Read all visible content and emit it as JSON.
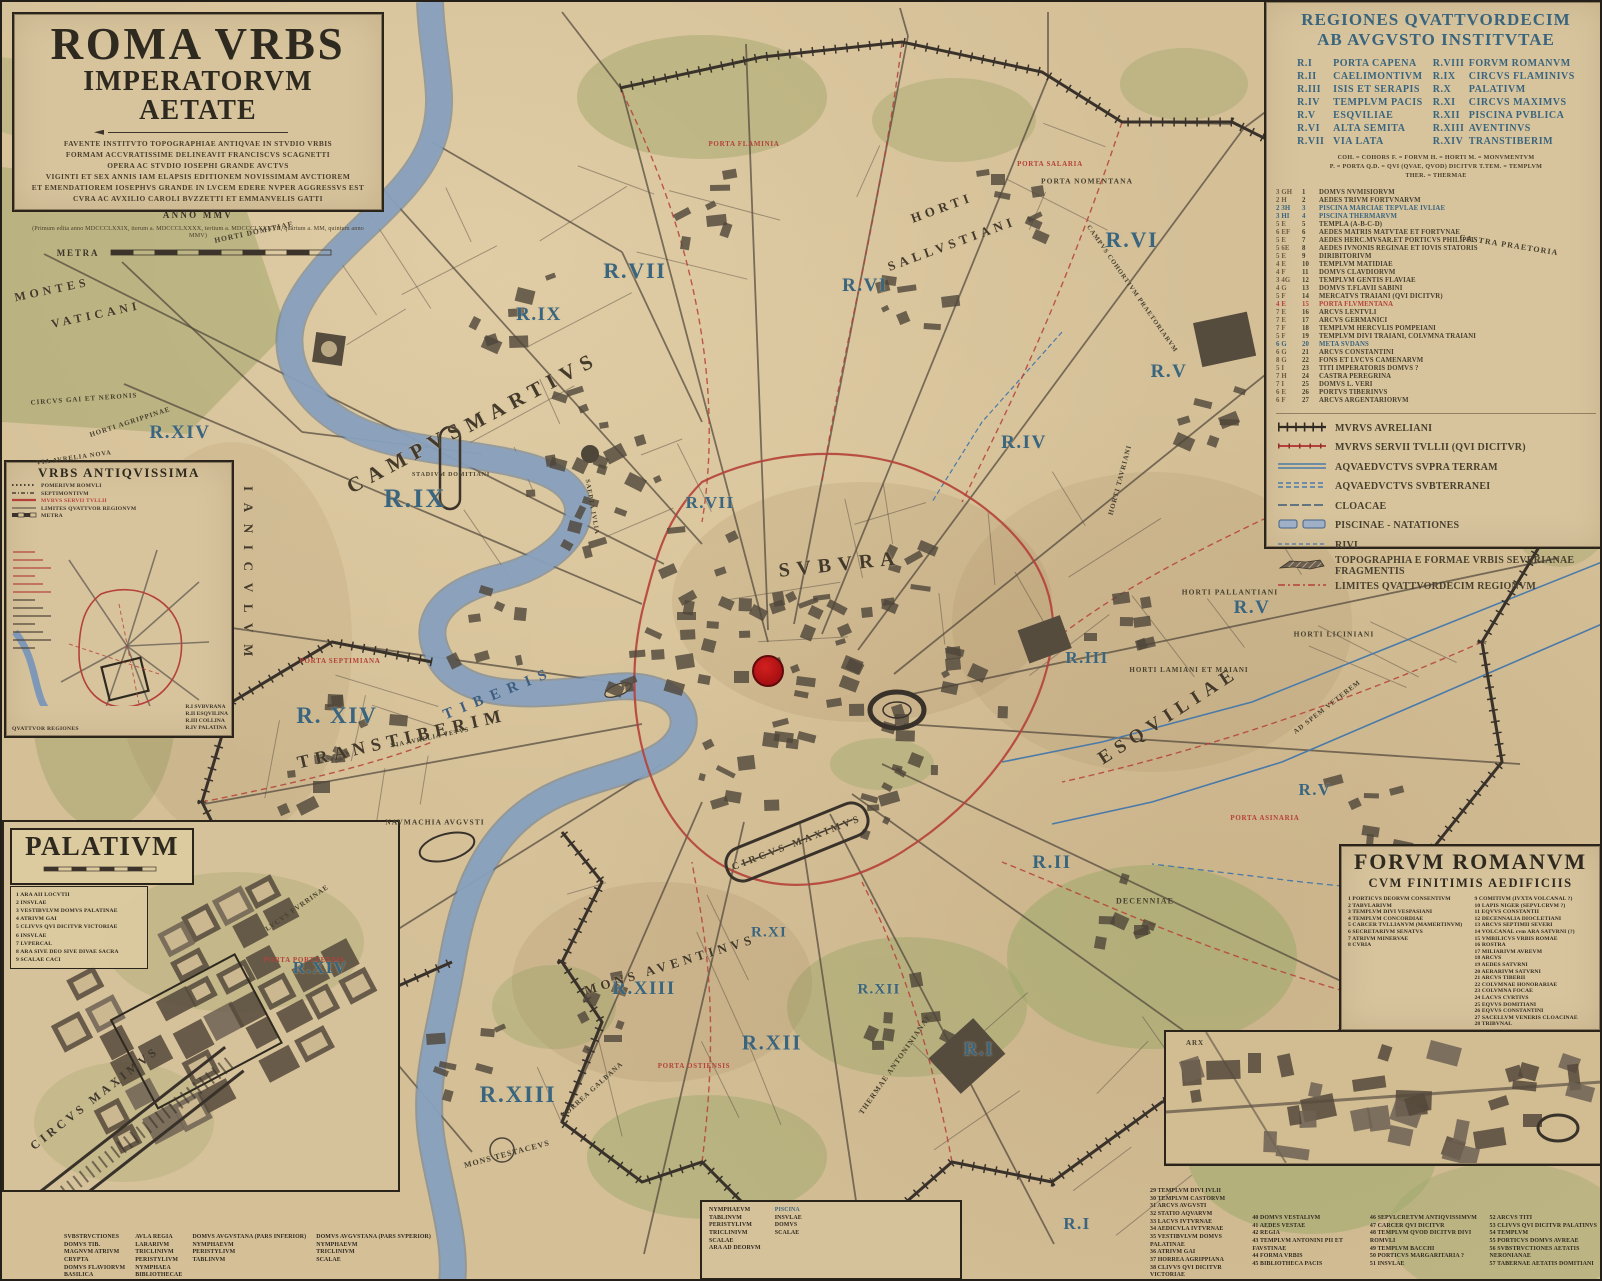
{
  "colors": {
    "parchment": "#d4bf97",
    "ink": "#3c342a",
    "region_blue": "#3a657f",
    "accent_red": "#b5413a",
    "river": "#8ba3c0",
    "dot": "#bf1419"
  },
  "title_block": {
    "title": "ROMA VRBS",
    "subtitle": "IMPERATORVM AETATE",
    "dedication": [
      "FAVENTE INSTITVTO TOPOGRAPHIAE ANTIQVAE IN STVDIO VRBIS",
      "FORMAM ACCVRATISSIME DELINEAVIT FRANCISCVS SCAGNETTI",
      "OPERA AC STVDIO IOSEPHI GRANDE AVCTVS",
      "VIGINTI ET SEX ANNIS IAM ELAPSIS EDITIONEM NOVISSIMAM AVCTIOREM",
      "ET EMENDATIOREM IOSEPHVS GRANDE IN LVCEM EDERE NVPER AGGRESSVS EST",
      "CVRA AC AVXILIO CAROLI BVZZETTI ET EMMANVELIS GATTI"
    ],
    "anno": "ANNO MMV",
    "editions": "(Primum edita anno MDCCCLXXIX, iterum a. MDCCCLXXXX, tertium a. MDCCCLXXXVII, quartum a. MM, quintum anno MMV)",
    "scale_label": "METRA"
  },
  "regiones_legend": {
    "title_line1": "REGIONES QVATTVORDECIM",
    "title_line2": "AB AVGVSTO INSTITVTAE",
    "regions": [
      {
        "num": "R.I",
        "name": "PORTA CAPENA"
      },
      {
        "num": "R.II",
        "name": "CAELIMONTIVM"
      },
      {
        "num": "R.III",
        "name": "ISIS ET SERAPIS"
      },
      {
        "num": "R.IV",
        "name": "TEMPLVM PACIS"
      },
      {
        "num": "R.V",
        "name": "ESQVILIAE"
      },
      {
        "num": "R.VI",
        "name": "ALTA SEMITA"
      },
      {
        "num": "R.VII",
        "name": "VIA LATA"
      },
      {
        "num": "R.VIII",
        "name": "FORVM ROMANVM"
      },
      {
        "num": "R.IX",
        "name": "CIRCVS FLAMINIVS"
      },
      {
        "num": "R.X",
        "name": "PALATIVM"
      },
      {
        "num": "R.XI",
        "name": "CIRCVS MAXIMVS"
      },
      {
        "num": "R.XII",
        "name": "PISCINA PVBLICA"
      },
      {
        "num": "R.XIII",
        "name": "AVENTINVS"
      },
      {
        "num": "R.XIV",
        "name": "TRANSTIBERIM"
      }
    ],
    "abbreviations": [
      "COH. = COHORS      F. = FORVM      H. = HORTI      M. = MONVMENTVM",
      "P. = PORTA      Q.D. = QVI (QVAE, QVOD) DICITVR      T.TEM. = TEMPLVM",
      "THER. = THERMAE"
    ],
    "monuments": [
      {
        "g": "3 GH",
        "n": "1",
        "t": "DOMVS NVMISIORVM"
      },
      {
        "g": "2 H",
        "n": "2",
        "t": "AEDES TRIVM FORTVNARVM"
      },
      {
        "g": "2 3H",
        "n": "3",
        "t": "PISCINA MARCIAE TEPVLAE IVLIAE",
        "c": "b"
      },
      {
        "g": "3 HI",
        "n": "4",
        "t": "PISCINA THERMARVM",
        "c": "b"
      },
      {
        "g": "5 E",
        "n": "5",
        "t": "TEMPLA  (A-B-C-D)"
      },
      {
        "g": "6 EF",
        "n": "6",
        "t": "AEDES MATRIS MATVTAE ET FORTVNAE"
      },
      {
        "g": "5 E",
        "n": "7",
        "t": "AEDES HERC.MVSAR.ET PORTICVS PHILIPPI"
      },
      {
        "g": "5 6E",
        "n": "8",
        "t": "AEDES IVNONIS REGINAE ET IOVIS STATORIS"
      },
      {
        "g": "5 E",
        "n": "9",
        "t": "DIRIBITORIVM"
      },
      {
        "g": "4 E",
        "n": "10",
        "t": "TEMPLVM MATIDIAE"
      },
      {
        "g": "4 F",
        "n": "11",
        "t": "DOMVS CLAVDIORVM"
      },
      {
        "g": "3 4G",
        "n": "12",
        "t": "TEMPLVM GENTIS FLAVIAE"
      },
      {
        "g": "4 G",
        "n": "13",
        "t": "DOMVS T.FLAVII SABINI"
      },
      {
        "g": "5 F",
        "n": "14",
        "t": "MERCATVS TRAIANI (QVI DICITVR)"
      },
      {
        "g": "4 E",
        "n": "15",
        "t": "PORTA FLVMENTANA",
        "c": "r"
      },
      {
        "g": "7 E",
        "n": "16",
        "t": "ARCVS LENTVLI"
      },
      {
        "g": "7 E",
        "n": "17",
        "t": "ARCVS GERMANICI"
      },
      {
        "g": "7 F",
        "n": "18",
        "t": "TEMPLVM HERCVLIS POMPEIANI"
      },
      {
        "g": "5 F",
        "n": "19",
        "t": "TEMPLVM DIVI TRAIANI, COLVMNA TRAIANI"
      },
      {
        "g": "6 G",
        "n": "20",
        "t": "META SVDANS",
        "c": "b"
      },
      {
        "g": "6 G",
        "n": "21",
        "t": "ARCVS CONSTANTINI"
      },
      {
        "g": "8 G",
        "n": "22",
        "t": "FONS ET LVCVS CAMENARVM"
      },
      {
        "g": "5 I",
        "n": "23",
        "t": "TITI IMPERATORIS DOMVS ?"
      },
      {
        "g": "7 H",
        "n": "24",
        "t": "CASTRA PEREGRINA"
      },
      {
        "g": "7 I",
        "n": "25",
        "t": "DOMVS L. VERI"
      },
      {
        "g": "6 E",
        "n": "26",
        "t": "PORTVS TIBERINVS"
      },
      {
        "g": "6 F",
        "n": "27",
        "t": "ARCVS ARGENTARIORVM"
      }
    ],
    "symbols": [
      {
        "type": "wall-black",
        "label": "MVRVS AVRELIANI"
      },
      {
        "type": "wall-red",
        "label": "MVRVS SERVII TVLLII (QVI DICITVR)"
      },
      {
        "type": "aq-solid",
        "label": "AQVAEDVCTVS SVPRA TERRAM"
      },
      {
        "type": "aq-dash",
        "label": "AQVAEDVCTVS SVBTERRANEI"
      },
      {
        "type": "cloacae",
        "label": "CLOACAE"
      },
      {
        "type": "piscinae",
        "label": "PISCINAE - NATATIONES"
      },
      {
        "type": "rivi",
        "label": "RIVI"
      },
      {
        "type": "frag",
        "label": "TOPOGRAPHIA E FORMAE VRBIS SEVERIANAE FRAGMENTIS"
      },
      {
        "type": "limites",
        "label": "LIMITES QVATTVORDECIM REGIONVM"
      }
    ]
  },
  "urbs_antiquissima": {
    "title": "VRBS ANTIQVISSIMA",
    "legend": [
      {
        "type": "pomerium",
        "label": "POMERIVM ROMVLI"
      },
      {
        "type": "septimontium",
        "label": "SEPTIMONTIVM"
      },
      {
        "type": "murus",
        "label": "MVRVS SERVII TVLLII",
        "red": true
      },
      {
        "type": "limites",
        "label": "LIMITES QVATTVOR REGIONVM"
      }
    ],
    "scale_label": "METRA",
    "regions_title": "QVATTVOR REGIONES",
    "regions": [
      "R.I  SVBVRANA",
      "R.II  ESQVILINA",
      "R.III  COLLINA",
      "R.IV  PALATINA"
    ]
  },
  "palatium": {
    "title": "PALATIVM",
    "items": [
      "1  ARA AII LOCVTII",
      "2  INSVLAE",
      "3  VESTIBVLVM DOMVS PALATINAE",
      "4  ATRIVM GAI",
      "5  CLIVVS QVI DICITVR VICTORIAE",
      "6  INSVLAE",
      "7  LVPERCAL",
      "8  ARA SIVE DEO SIVE DIVAE SACRA",
      "9  SCALAE CACI"
    ],
    "circus_label": "CIRCVS MAXIMVS",
    "strip1_cols": [
      [
        "SVBSTRVCTIONES",
        "DOMVS TIB.",
        "MAGNVM ATRIVM",
        "CRYPTA",
        "DOMVS FLAVIORVM",
        "BASILICA"
      ],
      [
        "AVLA REGIA",
        "LARARIVM",
        "TRICLINIVM",
        "PERISTYLIVM",
        "NYMPHAEA",
        "BIBLIOTHECAE"
      ],
      [
        "DOMVS AVGVSTANA (PARS INFERIOR)",
        "NYMPHAEVM",
        "PERISTYLIVM",
        "TABLINVM"
      ],
      [
        "DOMVS AVGVSTANA (PARS SVPERIOR)",
        "NYMPHAEVM",
        "TRICLINIVM",
        "SCALAE"
      ]
    ],
    "strip2_cols": [
      [
        "NYMPHAEVM",
        "TABLINVM",
        "PERISTYLIVM",
        "TRICLINIVM",
        "SCALAE",
        "ARA AD DEORVM"
      ],
      [
        "PISCINA",
        "INSVLAE",
        "DOMVS",
        "SCALAE"
      ]
    ]
  },
  "forum_romanum": {
    "title": "FORVM ROMANVM",
    "subtitle": "CVM FINITIMIS AEDIFICIIS",
    "col1": [
      {
        "n": "1",
        "t": "PORTICVS DEORVM CONSENTIVM"
      },
      {
        "n": "2",
        "t": "TABVLARIVM"
      },
      {
        "n": "3",
        "t": "TEMPLVM DIVI VESPASIANI"
      },
      {
        "n": "4",
        "t": "TEMPLVM CONCORDIAE"
      },
      {
        "n": "5",
        "t": "CARCER TVLLIANVM (MAMERTINVM)"
      },
      {
        "n": "6",
        "t": "SECRETARIVM SENATVS"
      },
      {
        "n": "7",
        "t": "ATRIVM MINERVAE"
      },
      {
        "n": "8",
        "t": "CVRIA"
      }
    ],
    "col2": [
      {
        "n": "9",
        "t": "COMITIVM (IVXTA VOLCANAL ?)"
      },
      {
        "n": "10",
        "t": "LAPIS NIGER (SEPVLCRVM ?)"
      },
      {
        "n": "11",
        "t": "EQVVS CONSTANTII"
      },
      {
        "n": "12",
        "t": "DECENNALIA DIOCLETIANI"
      },
      {
        "n": "13",
        "t": "ARCVS SEPTIMII SEVERI"
      },
      {
        "n": "14",
        "t": "VOLCANAL cvm ARA SATVRNI (?)"
      },
      {
        "n": "15",
        "t": "VMBILICVS VRBIS ROMAE"
      },
      {
        "n": "16",
        "t": "ROSTRA"
      },
      {
        "n": "17",
        "t": "MILIARIVM AVREVM"
      },
      {
        "n": "18",
        "t": "ARCVS"
      },
      {
        "n": "19",
        "t": "AEDES SATVRNI"
      },
      {
        "n": "20",
        "t": "AERARIVM SATVRNI"
      },
      {
        "n": "21",
        "t": "ARCVS TIBERII"
      },
      {
        "n": "22",
        "t": "COLVMNAE HONORARIAE"
      },
      {
        "n": "23",
        "t": "COLVMNA FOCAE"
      },
      {
        "n": "24",
        "t": "LACVS CVRTIVS"
      },
      {
        "n": "25",
        "t": "EQVVS DOMITIANI"
      },
      {
        "n": "26",
        "t": "EQVVS CONSTANTINI"
      },
      {
        "n": "27",
        "t": "SACELLVM VENERIS CLOACINAE"
      },
      {
        "n": "28",
        "t": "TRIBVNAL"
      }
    ],
    "strip_cols": [
      [
        {
          "n": "29",
          "t": "TEMPLVM DIVI IVLII"
        },
        {
          "n": "30",
          "t": "TEMPLVM CASTORVM"
        },
        {
          "n": "31",
          "t": "ARCVS AVGVSTI"
        },
        {
          "n": "32",
          "t": "STATIO AQVARVM"
        },
        {
          "n": "33",
          "t": "LACVS IVTVRNAE"
        },
        {
          "n": "34",
          "t": "AEDICVLA IVTVRNAE"
        },
        {
          "n": "35",
          "t": "VESTIBVLVM DOMVS PALATINAE"
        },
        {
          "n": "36",
          "t": "ATRIVM GAI"
        },
        {
          "n": "37",
          "t": "HORREA AGRIPPIANA"
        },
        {
          "n": "38",
          "t": "CLIVVS QVI DICITVR VICTORIAE"
        },
        {
          "n": "39",
          "t": "ARA AII LOCVTII"
        }
      ],
      [
        {
          "n": "40",
          "t": "DOMVS VESTALIVM"
        },
        {
          "n": "41",
          "t": "AEDES VESTAE"
        },
        {
          "n": "42",
          "t": "REGIA"
        },
        {
          "n": "43",
          "t": "TEMPLVM ANTONINI PII ET FAVSTINAE"
        },
        {
          "n": "44",
          "t": "FORMA VRBIS"
        },
        {
          "n": "45",
          "t": "BIBLIOTHECA PACIS"
        }
      ],
      [
        {
          "n": "46",
          "t": "SEPVLCRETVM ANTIQVISSIMVM"
        },
        {
          "n": "47",
          "t": "CARCER QVI DICITVR"
        },
        {
          "n": "48",
          "t": "TEMPLVM QVOD DICITVR DIVI ROMVLI"
        },
        {
          "n": "49",
          "t": "TEMPLVM BACCHI"
        },
        {
          "n": "50",
          "t": "PORTICVS MARGARITARIA ?"
        },
        {
          "n": "51",
          "t": "INSVLAE"
        }
      ],
      [
        {
          "n": "52",
          "t": "ARCVS TITI"
        },
        {
          "n": "53",
          "t": "CLIVVS QVI DICITVR PALATINVS"
        },
        {
          "n": "54",
          "t": "TEMPLVM"
        },
        {
          "n": "55",
          "t": "PORTICVS DOMVS AVREAE"
        },
        {
          "n": "56",
          "t": "SVBSTRVCTIONES AETATIS NERONIANAE"
        },
        {
          "n": "57",
          "t": "TABERNAE AETATIS DOMITIANI"
        }
      ]
    ]
  },
  "map_labels": [
    {
      "t": "R.IX",
      "x": 413,
      "y": 497,
      "s": 26,
      "r": 0,
      "c": "rg"
    },
    {
      "t": "R.IX",
      "x": 537,
      "y": 313,
      "s": 19,
      "r": 0,
      "c": "rg"
    },
    {
      "t": "R.VII",
      "x": 633,
      "y": 269,
      "s": 22,
      "r": 0,
      "c": "rg"
    },
    {
      "t": "R.VII",
      "x": 708,
      "y": 501,
      "s": 17,
      "r": 0,
      "c": "rg"
    },
    {
      "t": "R.VI",
      "x": 863,
      "y": 284,
      "s": 19,
      "r": 0,
      "c": "rg"
    },
    {
      "t": "R.VI",
      "x": 1130,
      "y": 238,
      "s": 22,
      "r": 0,
      "c": "rg"
    },
    {
      "t": "R.V",
      "x": 1167,
      "y": 370,
      "s": 19,
      "r": 0,
      "c": "rg"
    },
    {
      "t": "R.V",
      "x": 1250,
      "y": 606,
      "s": 19,
      "r": 0,
      "c": "rg"
    },
    {
      "t": "R.V",
      "x": 1313,
      "y": 788,
      "s": 17,
      "r": 0,
      "c": "rg"
    },
    {
      "t": "R.IV",
      "x": 1022,
      "y": 441,
      "s": 19,
      "r": 0,
      "c": "rg"
    },
    {
      "t": "R.III",
      "x": 1085,
      "y": 656,
      "s": 17,
      "r": 0,
      "c": "rg"
    },
    {
      "t": "R.II",
      "x": 1050,
      "y": 861,
      "s": 19,
      "r": 0,
      "c": "rg"
    },
    {
      "t": "R.I",
      "x": 977,
      "y": 1048,
      "s": 19,
      "r": 0,
      "c": "rg"
    },
    {
      "t": "R.I",
      "x": 1075,
      "y": 1222,
      "s": 17,
      "r": 0,
      "c": "rg"
    },
    {
      "t": "R.XIV",
      "x": 178,
      "y": 431,
      "s": 19,
      "r": 0,
      "c": "rg"
    },
    {
      "t": "R. XIV",
      "x": 335,
      "y": 714,
      "s": 23,
      "r": 0,
      "c": "rg"
    },
    {
      "t": "R.XIV",
      "x": 318,
      "y": 966,
      "s": 17,
      "r": 0,
      "c": "rg"
    },
    {
      "t": "R.XIII",
      "x": 642,
      "y": 987,
      "s": 19,
      "r": 0,
      "c": "rg"
    },
    {
      "t": "R.XIII",
      "x": 516,
      "y": 1093,
      "s": 23,
      "r": 0,
      "c": "rg"
    },
    {
      "t": "R.XII",
      "x": 770,
      "y": 1041,
      "s": 21,
      "r": 0,
      "c": "rg"
    },
    {
      "t": "R.XII",
      "x": 877,
      "y": 988,
      "s": 15,
      "r": 0,
      "c": "rg"
    },
    {
      "t": "R.XI",
      "x": 767,
      "y": 931,
      "s": 15,
      "r": 0,
      "c": "rg"
    },
    {
      "t": "CAMPVS",
      "x": 405,
      "y": 455,
      "s": 21,
      "r": -28,
      "c": "ar"
    },
    {
      "t": "MARTIVS",
      "x": 530,
      "y": 390,
      "s": 21,
      "r": -28,
      "c": "ar"
    },
    {
      "t": "SVBVRA",
      "x": 838,
      "y": 563,
      "s": 20,
      "r": -6,
      "c": "ar"
    },
    {
      "t": "ESQVILIAE",
      "x": 1167,
      "y": 714,
      "s": 19,
      "r": -33,
      "c": "ar"
    },
    {
      "t": "TRANSTIBERIM",
      "x": 400,
      "y": 737,
      "s": 18,
      "r": -13,
      "c": "ar"
    },
    {
      "t": "MONS AVENTINVS",
      "x": 668,
      "y": 963,
      "s": 13,
      "r": -17,
      "c": "ar"
    },
    {
      "t": "HORTI",
      "x": 940,
      "y": 206,
      "s": 13,
      "r": -20,
      "c": "ar"
    },
    {
      "t": "SALLVSTIANI",
      "x": 950,
      "y": 242,
      "s": 13,
      "r": -20,
      "c": "ar"
    },
    {
      "t": "MONTES",
      "x": 50,
      "y": 288,
      "s": 12,
      "r": -12,
      "c": "ar"
    },
    {
      "t": "VATICANI",
      "x": 94,
      "y": 313,
      "s": 12,
      "r": -12,
      "c": "ar"
    },
    {
      "t": "CIRCVS MAXIMVS",
      "x": 795,
      "y": 841,
      "s": 10,
      "r": -21,
      "c": "ar"
    },
    {
      "t": "IANICVLVM",
      "x": 246,
      "y": 575,
      "s": 13,
      "r": 90,
      "c": "ar"
    },
    {
      "t": "TIBERIS",
      "x": 497,
      "y": 692,
      "s": 15,
      "r": -22,
      "c": "rv"
    },
    {
      "t": "CASTRA PRAETORIA",
      "x": 1507,
      "y": 243,
      "s": 8,
      "r": 9,
      "c": "sm"
    },
    {
      "t": "CAMPVS COHORTIVM PRAETORIARVM",
      "x": 1130,
      "y": 287,
      "s": 6.5,
      "r": 55,
      "c": "sm"
    },
    {
      "t": "SAEPTA IVLIA",
      "x": 590,
      "y": 505,
      "s": 6.5,
      "r": 80,
      "c": "sm"
    },
    {
      "t": "STADIVM DOMITIANI",
      "x": 449,
      "y": 473,
      "s": 6,
      "r": 0,
      "c": "sm"
    },
    {
      "t": "HORTI DOMITIAE",
      "x": 252,
      "y": 230,
      "s": 7.5,
      "r": -12,
      "c": "sm"
    },
    {
      "t": "CIRCVS GAI ET NERONIS",
      "x": 82,
      "y": 397,
      "s": 7,
      "r": -4,
      "c": "sm"
    },
    {
      "t": "HORTI AGRIPPINAE",
      "x": 128,
      "y": 420,
      "s": 7,
      "r": -18,
      "c": "sm"
    },
    {
      "t": "VIA AVRELIA NOVA",
      "x": 72,
      "y": 456,
      "s": 6.5,
      "r": -8,
      "c": "sm"
    },
    {
      "t": "VIA AVRELIA VETVS",
      "x": 428,
      "y": 736,
      "s": 6.5,
      "r": -12,
      "c": "sm"
    },
    {
      "t": "NAVMACHIA AVGVSTI",
      "x": 433,
      "y": 820,
      "s": 7.5,
      "r": 0,
      "c": "sm"
    },
    {
      "t": "HORREA GALBANA",
      "x": 590,
      "y": 1088,
      "s": 7,
      "r": -42,
      "c": "sm"
    },
    {
      "t": "MONS TESTACEVS",
      "x": 505,
      "y": 1152,
      "s": 8,
      "r": -15,
      "c": "sm"
    },
    {
      "t": "LVCVS FVRRINAE",
      "x": 295,
      "y": 906,
      "s": 7,
      "r": -35,
      "c": "sm"
    },
    {
      "t": "DECENNIAE",
      "x": 1143,
      "y": 899,
      "s": 8,
      "r": 0,
      "c": "sm"
    },
    {
      "t": "HORTI PALLANTIANI",
      "x": 1228,
      "y": 590,
      "s": 7.5,
      "r": 0,
      "c": "sm"
    },
    {
      "t": "HORTI LICINIANI",
      "x": 1332,
      "y": 632,
      "s": 7.5,
      "r": 0,
      "c": "sm"
    },
    {
      "t": "HORTI LAMIANI ET MAIANI",
      "x": 1187,
      "y": 668,
      "s": 7,
      "r": 0,
      "c": "sm"
    },
    {
      "t": "AD SPEM VETEREM",
      "x": 1325,
      "y": 705,
      "s": 7,
      "r": -38,
      "c": "sm"
    },
    {
      "t": "HORTI TAVRIANI",
      "x": 1118,
      "y": 478,
      "s": 7,
      "r": -75,
      "c": "sm"
    },
    {
      "t": "THERMAE ANTONINIANAE",
      "x": 893,
      "y": 1062,
      "s": 7.5,
      "r": -55,
      "c": "sm"
    },
    {
      "t": "PORTA NOMENTANA",
      "x": 1085,
      "y": 179,
      "s": 7.5,
      "r": 0,
      "c": "sm"
    },
    {
      "t": "HORTI SALVSTIANI",
      "x": 700,
      "y": 215,
      "s": 0,
      "r": 0,
      "c": "none"
    },
    {
      "t": "ARX",
      "x": 1193,
      "y": 1041,
      "s": 7,
      "r": 0,
      "c": "sm"
    },
    {
      "t": "PORTA FLAMINIA",
      "x": 742,
      "y": 142,
      "s": 7,
      "r": 0,
      "c": "rd"
    },
    {
      "t": "PORTA SALARIA",
      "x": 1048,
      "y": 162,
      "s": 7,
      "r": 0,
      "c": "rd"
    },
    {
      "t": "PORTA ASINARIA",
      "x": 1263,
      "y": 816,
      "s": 7,
      "r": 0,
      "c": "rd"
    },
    {
      "t": "PORTA OSTIENSIS",
      "x": 692,
      "y": 1064,
      "s": 7,
      "r": 0,
      "c": "rd"
    },
    {
      "t": "PORTA SEPTIMIANA",
      "x": 338,
      "y": 659,
      "s": 7,
      "r": 0,
      "c": "rd"
    },
    {
      "t": "PORTA PORTVENSIS",
      "x": 302,
      "y": 958,
      "s": 7,
      "r": 0,
      "c": "rd"
    }
  ],
  "marker": {
    "label": "current-location"
  }
}
